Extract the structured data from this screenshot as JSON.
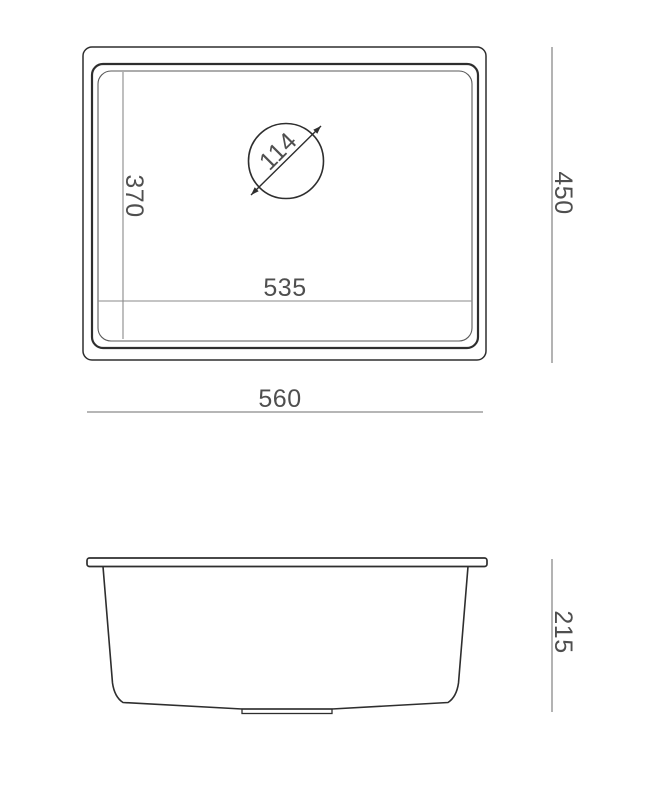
{
  "drawing": {
    "title": "Undermount sink technical dimension drawing",
    "top_view": {
      "overall_width": "560",
      "overall_depth": "450",
      "bowl_width": "535",
      "bowl_depth": "370",
      "drain_diameter": "114"
    },
    "side_view": {
      "overall_height": "215"
    },
    "colors": {
      "outline": "#2e2e2e",
      "rim_inner_line": "#5a5a5a",
      "dimension_line": "#8a8a8a",
      "dimension_text": "#4f4f4f",
      "background": "#ffffff"
    }
  }
}
